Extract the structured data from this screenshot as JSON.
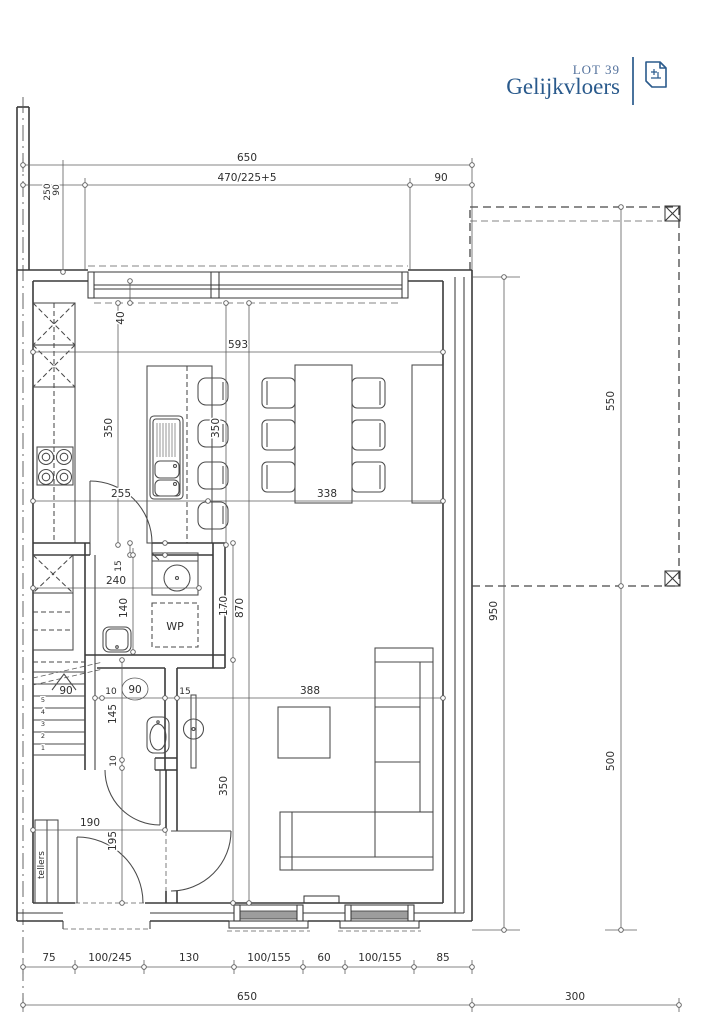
{
  "title_block": {
    "lot_label": "LOT 39",
    "floor_label": "Gelijkvloers"
  },
  "icons": {
    "title_icon": "floorplan-sheet-icon"
  },
  "colors": {
    "accent_blue": "#2a5a8c",
    "lot_blue": "#53719c",
    "drawing_line": "#3a3a3a",
    "dimension_line": "#5c5c5c"
  },
  "room_labels": {
    "heat_pump": "WP",
    "meter_cabinet": "tellers"
  },
  "dims": {
    "top_total": "650",
    "top_opening": "470/225+5",
    "top_right_pier": "90",
    "top_left_pier": "90",
    "top_left_axis": "250",
    "window_depth": "40",
    "interior_width": "593",
    "island_length": "350",
    "island_side": "350",
    "counter_to_island": "255",
    "dining_width": "338",
    "storage_wall": "15",
    "storage_width": "240",
    "storage_height": "140",
    "storage_outer": "170",
    "interior_height": "870",
    "wc_jamb": "10",
    "wc_door_width": "90",
    "wc_wall": "15",
    "living_width": "388",
    "wc_length": "145",
    "wc_bottom_wall": "10",
    "living_height": "350",
    "hall_width": "190",
    "hall_height": "195",
    "facade_segments": [
      "75",
      "100/245",
      "130",
      "100/155",
      "60",
      "100/155",
      "85"
    ],
    "facade_total": "650",
    "terrace_width": "300",
    "terrace_length": "550",
    "side_total": "950",
    "terrace_side": "500"
  },
  "stairs": {
    "width": "90",
    "treads": [
      "1",
      "2",
      "3",
      "4",
      "5"
    ]
  }
}
